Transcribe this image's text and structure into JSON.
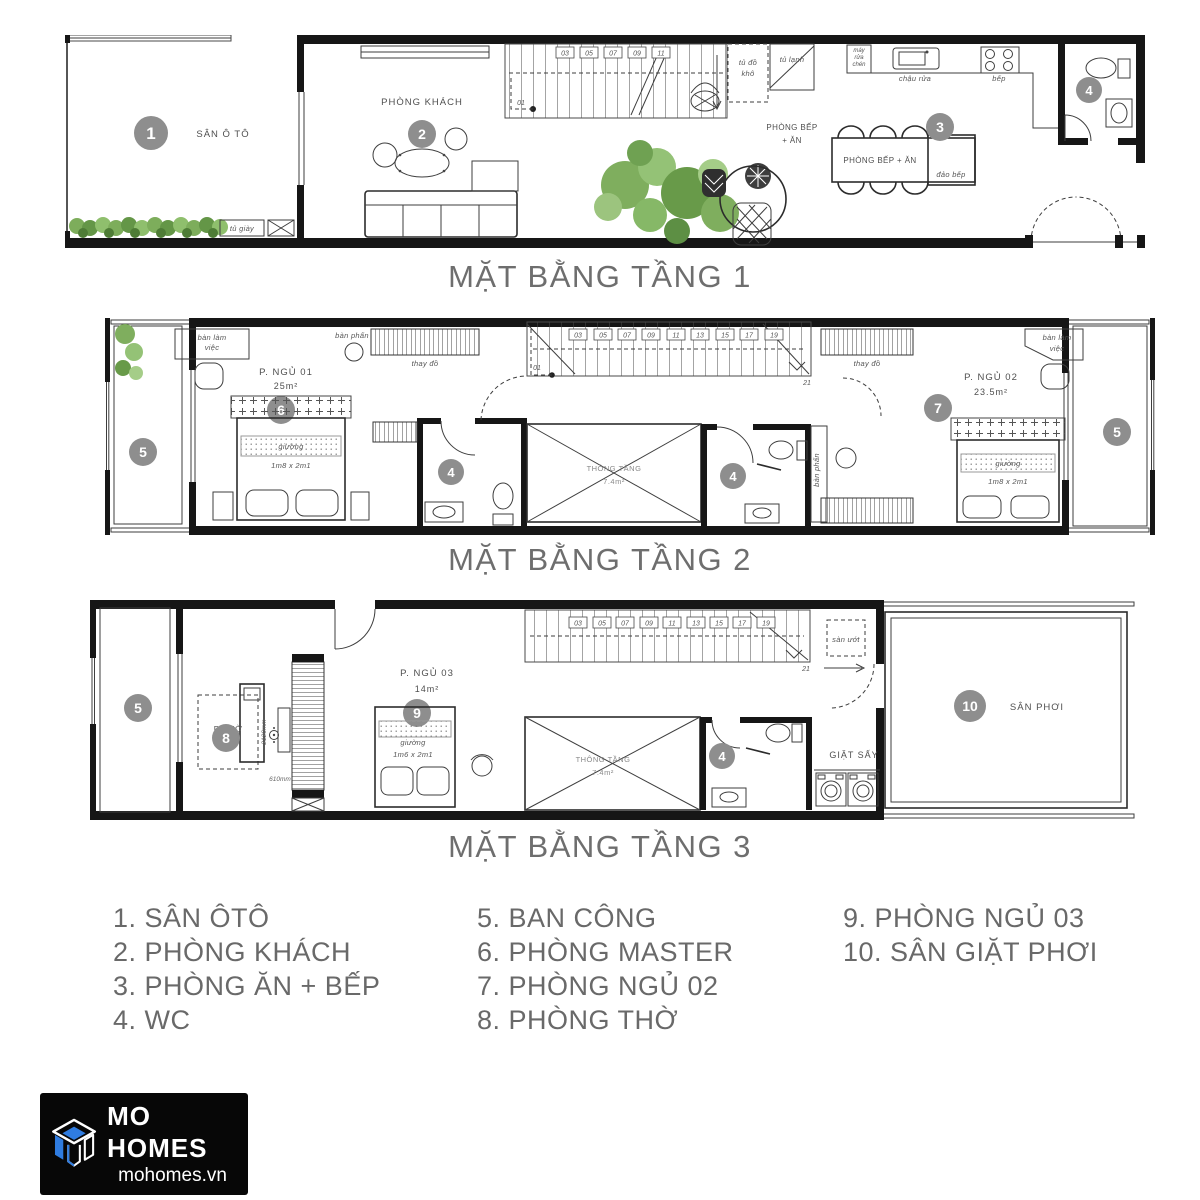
{
  "colors": {
    "wall": "#161616",
    "line": "#3e3e3e",
    "marker": "#8e8e8e",
    "marker_text": "#ffffff",
    "title_text": "#6e6e6e",
    "legend_text": "#696969",
    "plant_green": "#7fae5e",
    "plant_green_dark": "#5d8f44",
    "plant_green_light": "#9cc47e",
    "logo_bg": "#070707",
    "logo_blue": "#2f7ce0",
    "logo_text": "#ffffff"
  },
  "markers": {
    "m1": "1",
    "m2": "2",
    "m3": "3",
    "m4": "4",
    "m5": "5",
    "m6": "6",
    "m7": "7",
    "m8": "8",
    "m9": "9",
    "m10": "10"
  },
  "floors": [
    {
      "title": "MẶT BẰNG TẦNG 1",
      "labels": {
        "san_oto": "SÂN Ô TÔ",
        "tu_giay": "tủ giày",
        "phong_khach": "PHÒNG KHÁCH",
        "tu_do_kho_1": "tủ đồ",
        "tu_do_kho_2": "khô",
        "tu_lanh": "tủ lạnh",
        "may_rua_chen_1": "máy",
        "may_rua_chen_2": "rửa",
        "may_rua_chen_3": "chén",
        "chau_rua": "chậu rửa",
        "bep": "bếp",
        "phong_bep_an_1": "PHÒNG BẾP",
        "phong_bep_an_2": "+ ĂN",
        "phong_bep_an_table": "PHÒNG BẾP + ĂN",
        "dao_bep": "đảo bếp",
        "stair_start": "01"
      },
      "stairs": [
        "03",
        "05",
        "07",
        "09",
        "11"
      ]
    },
    {
      "title": "MẶT BẰNG TẦNG 2",
      "labels": {
        "ban_lam_viec_1": "bàn làm",
        "ban_lam_viec_2": "việc",
        "ban_phan": "bàn phấn",
        "thay_do": "thay đồ",
        "p_ngu_01": "P. NGỦ 01",
        "p_ngu_01_area": "25m²",
        "giuong": "giường",
        "giuong_size": "1m8 x 2m1",
        "thong_tang": "THÔNG TẦNG",
        "thong_tang_area": "7.4m²",
        "p_ngu_02": "P. NGỦ 02",
        "p_ngu_02_area": "23.5m²",
        "stair_start": "01",
        "stair_end": "21"
      },
      "stairs": [
        "03",
        "05",
        "07",
        "09",
        "11",
        "13",
        "15",
        "17",
        "19"
      ]
    },
    {
      "title": "MẶT BẰNG TẦNG 3",
      "labels": {
        "p_tho": "P. THỜ",
        "dim_2120": "2120mm",
        "dim_610": "610mm",
        "p_ngu_03": "P. NGỦ 03",
        "p_ngu_03_area": "14m²",
        "giuong": "giường",
        "giuong_size": "1m6 x 2m1",
        "san_uot": "sàn ướt",
        "thong_tang": "THÔNG TẦNG",
        "thong_tang_area": "7.4m²",
        "giat_say": "GIẶT SẤY",
        "san_phoi": "SÂN PHƠI",
        "stair_end": "21"
      },
      "stairs": [
        "03",
        "05",
        "07",
        "09",
        "11",
        "13",
        "15",
        "17",
        "19"
      ]
    }
  ],
  "legend": {
    "col1": [
      "1. SÂN ÔTÔ",
      "2. PHÒNG KHÁCH",
      "3. PHÒNG ĂN + BẾP",
      "4. WC"
    ],
    "col2": [
      "5. BAN CÔNG",
      "6. PHÒNG MASTER",
      "7. PHÒNG NGỦ 02",
      "8. PHÒNG THỜ"
    ],
    "col3": [
      "9. PHÒNG NGỦ 03",
      "10. SÂN GIẶT PHƠI"
    ]
  },
  "logo": {
    "brand": "MO HOMES",
    "domain": "mohomes.vn"
  }
}
